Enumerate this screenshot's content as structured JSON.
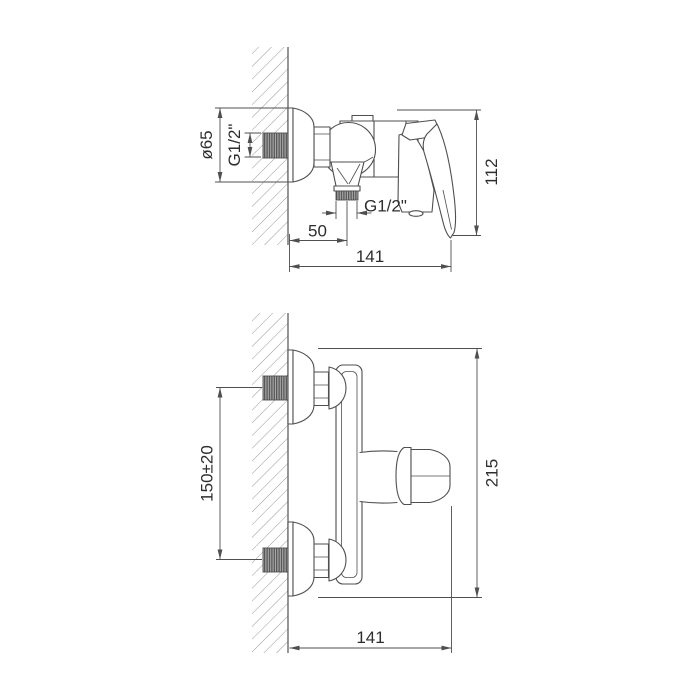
{
  "drawing": {
    "type": "technical-dimension-drawing",
    "subject": "wall-mounted shower mixer tap, two orthographic views",
    "colors": {
      "background": "#ffffff",
      "line": "#4f4f4f",
      "hatch": "#999999",
      "text": "#2e2e2e"
    },
    "side_view": {
      "dims": {
        "escutcheon_diameter": "ø65",
        "inlet_thread": "G1/2\"",
        "outlet_thread": "G1/2\"",
        "wall_to_outlet_center": "50",
        "overall_depth": "141",
        "overall_height": "112"
      }
    },
    "front_view": {
      "dims": {
        "inlet_spacing": "150±20",
        "overall_height": "215",
        "overall_depth": "141"
      }
    }
  }
}
